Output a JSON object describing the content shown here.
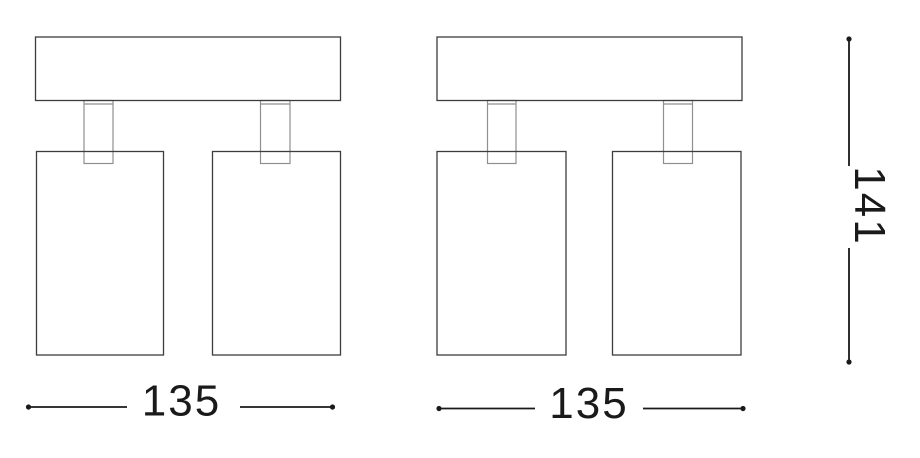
{
  "canvas": {
    "background": "#ffffff"
  },
  "drawing": {
    "outline_color": "#3d3d3d",
    "joint_color": "#8f8f8f",
    "dimension_color": "#1a1a1a"
  },
  "dimensions": {
    "width_left": "135",
    "width_right": "135",
    "height": "141"
  }
}
